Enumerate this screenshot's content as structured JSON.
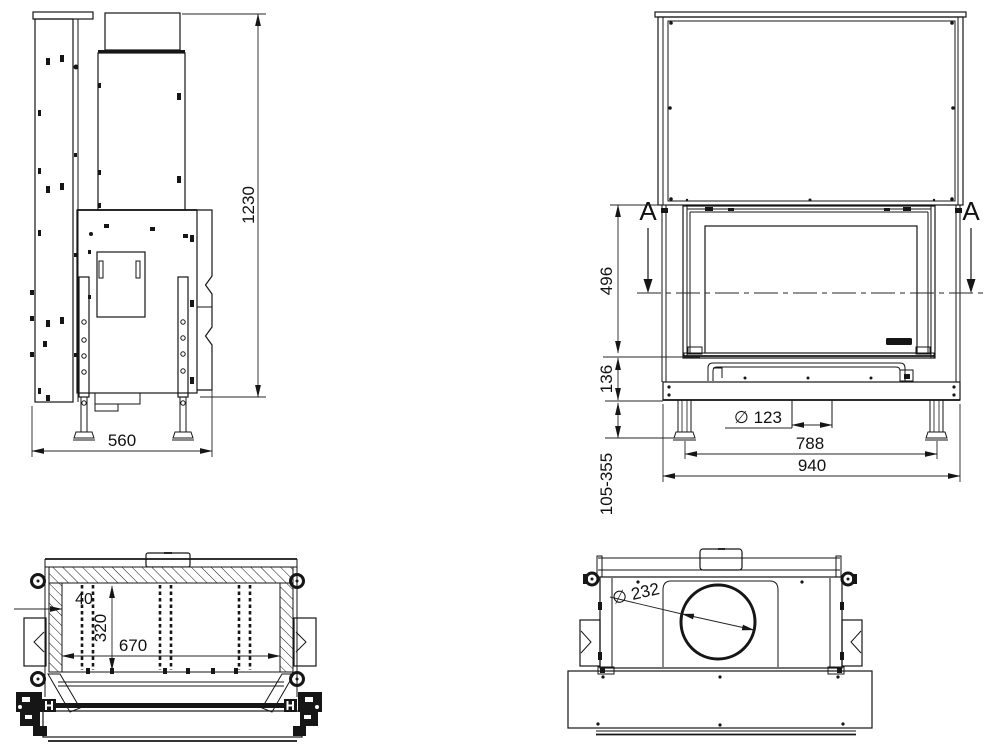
{
  "colors": {
    "background": "#ffffff",
    "line": "#161616",
    "dimension_text": "#111111"
  },
  "views": {
    "side": {
      "dim_depth": "560",
      "dim_total_height": "1230"
    },
    "front": {
      "section_label": "A",
      "dim_door_height": "496",
      "dim_base_height": "136",
      "dim_leg_range": "105-355",
      "dim_air_inlet_diameter": "∅ 123",
      "dim_leg_spacing": "788",
      "dim_overall_width": "940"
    },
    "section_aa": {
      "dim_wall_thickness": "40",
      "dim_inner_depth": "320",
      "dim_inner_width": "670"
    },
    "top": {
      "dim_flue_diameter": "∅ 232"
    }
  }
}
